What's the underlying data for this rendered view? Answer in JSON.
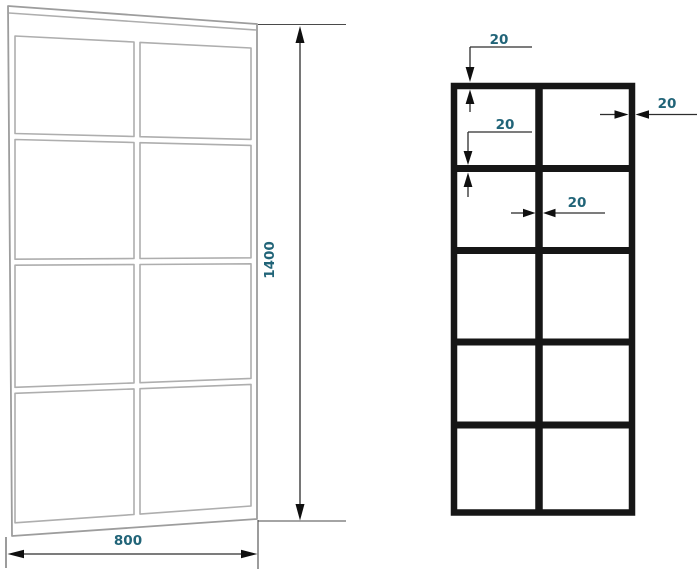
{
  "drawing": {
    "left_view": {
      "kind": "perspective-sketch-panel",
      "grid_rows": 4,
      "grid_cols": 2,
      "width_dim_label": "800",
      "height_dim_label": "1400"
    },
    "right_view": {
      "kind": "front-elevation-panel",
      "grid_rows": 5,
      "grid_cols": 2,
      "top_profile_dim_label": "20",
      "right_profile_dim_label": "20",
      "rail_profile_dim_label": "20",
      "mullion_profile_dim_label": "20"
    },
    "colors": {
      "dimension_text": "#216478",
      "dimension_line": "#2d2d2d",
      "sketch_line": "#aeaeae",
      "frame_line": "#161616",
      "background": "#ffffff"
    }
  }
}
